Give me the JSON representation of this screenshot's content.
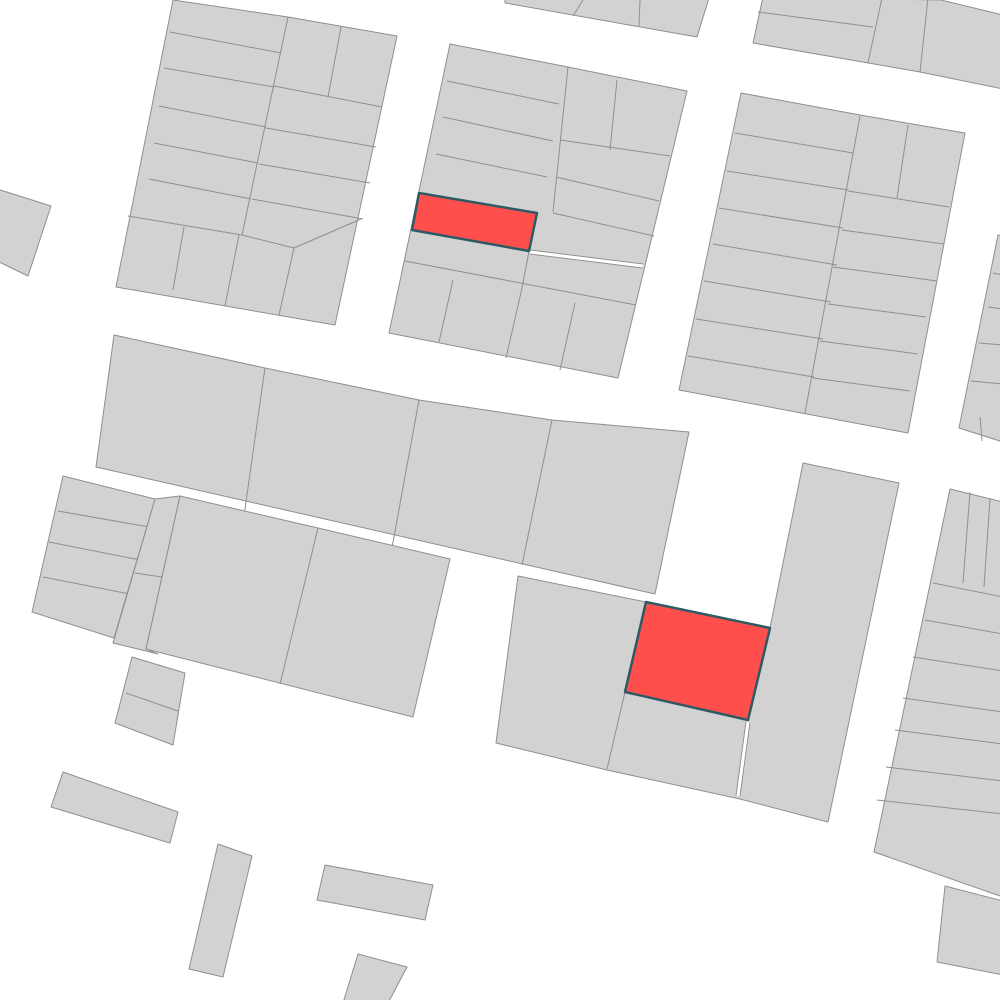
{
  "map": {
    "canvas": {
      "width": 1000,
      "height": 1000,
      "background_color": "#ffffff"
    },
    "style": {
      "parcel_fill": "#d2d2d2",
      "parcel_stroke": "#8f8f8f",
      "parcel_stroke_width": 1,
      "highlight_fill": "#ff4f4d",
      "highlight_stroke": "#2e5a63",
      "highlight_stroke_width": 2.5,
      "alley_fill": "#ffffff",
      "alley_width": 3,
      "alley_edge_offset": 2
    },
    "blocks": [
      {
        "name": "block-top-left",
        "outline": [
          173,
          0,
          288,
          17,
          397,
          36,
          335,
          325,
          116,
          287
        ],
        "lines": [
          [
            288,
            17,
            242,
            235
          ],
          [
            170,
            32,
            281,
            53
          ],
          [
            164,
            68,
            274,
            87
          ],
          [
            159,
            106,
            266,
            127
          ],
          [
            154,
            143,
            258,
            163
          ],
          [
            149,
            179,
            251,
            199
          ],
          [
            128,
            216,
            242,
            235
          ],
          [
            341,
            27,
            328,
            97
          ],
          [
            274,
            86,
            382,
            107
          ],
          [
            266,
            128,
            376,
            147
          ],
          [
            259,
            164,
            370,
            183
          ],
          [
            252,
            199,
            363,
            219
          ],
          [
            242,
            235,
            294,
            248
          ],
          [
            294,
            248,
            361,
            219
          ],
          [
            184,
            227,
            173,
            290
          ],
          [
            239,
            235,
            225,
            306
          ],
          [
            294,
            248,
            279,
            315
          ]
        ]
      },
      {
        "name": "block-left-edge-sliver",
        "outline": [
          -3,
          189,
          51,
          206,
          28,
          276,
          -3,
          261
        ],
        "lines": []
      },
      {
        "name": "block-top-center",
        "outline": [
          450,
          44,
          568,
          67,
          687,
          91,
          618,
          378,
          389,
          333
        ],
        "lines": [
          [
            568,
            67,
            553,
            212
          ],
          [
            529,
            251,
            522,
            288
          ],
          [
            447,
            81,
            559,
            104
          ],
          [
            443,
            117,
            553,
            141
          ],
          [
            436,
            154,
            547,
            177
          ],
          [
            405,
            261,
            636,
            305
          ],
          [
            617,
            80,
            610,
            150
          ],
          [
            560,
            140,
            670,
            156
          ],
          [
            556,
            177,
            659,
            201
          ],
          [
            553,
            213,
            654,
            236
          ],
          [
            453,
            280,
            439,
            342
          ],
          [
            522,
            288,
            506,
            358
          ],
          [
            575,
            303,
            560,
            370
          ]
        ]
      },
      {
        "name": "block-top-strip-west",
        "outline": [
          505,
          -2,
          709,
          -2,
          697,
          37,
          505,
          3
        ],
        "lines": [
          [
            583,
            0,
            573,
            16
          ],
          [
            640,
            0,
            639,
            26
          ]
        ]
      },
      {
        "name": "block-top-strip-east",
        "outline": [
          763,
          -3,
          941,
          0,
          1003,
          15,
          1003,
          89,
          920,
          72,
          753,
          43
        ],
        "lines": [
          [
            758,
            12,
            873,
            27
          ],
          [
            882,
            -2,
            868,
            63
          ],
          [
            928,
            -2,
            920,
            72
          ]
        ]
      },
      {
        "name": "block-top-right",
        "outline": [
          741,
          93,
          860,
          115,
          965,
          133,
          908,
          433,
          679,
          390
        ],
        "lines": [
          [
            860,
            116,
            805,
            413
          ],
          [
            735,
            133,
            853,
            153
          ],
          [
            727,
            171,
            848,
            190
          ],
          [
            719,
            208,
            843,
            228
          ],
          [
            713,
            244,
            837,
            265
          ],
          [
            704,
            281,
            831,
            302
          ],
          [
            696,
            319,
            823,
            339
          ],
          [
            688,
            356,
            814,
            377
          ],
          [
            908,
            125,
            897,
            198
          ],
          [
            848,
            191,
            949,
            207
          ],
          [
            842,
            230,
            944,
            244
          ],
          [
            833,
            267,
            937,
            281
          ],
          [
            828,
            304,
            926,
            317
          ],
          [
            820,
            341,
            918,
            354
          ],
          [
            813,
            378,
            910,
            391
          ]
        ]
      },
      {
        "name": "block-right-edge-upper",
        "outline": [
          998,
          235,
          1003,
          236,
          1003,
          442,
          959,
          428
        ],
        "lines": [
          [
            993,
            273,
            1003,
            275
          ],
          [
            988,
            307,
            1003,
            309
          ],
          [
            979,
            343,
            1003,
            345
          ],
          [
            971,
            381,
            1003,
            384
          ],
          [
            980,
            417,
            982,
            441
          ]
        ]
      },
      {
        "name": "block-middle-band",
        "outline": [
          114,
          335,
          265,
          368,
          419,
          400,
          552,
          420,
          689,
          432,
          655,
          594,
          96,
          467
        ],
        "lines": [
          [
            265,
            368,
            241,
            537
          ],
          [
            419,
            400,
            387,
            575
          ],
          [
            552,
            420,
            522,
            565
          ]
        ]
      },
      {
        "name": "block-left-strips",
        "outline": [
          63,
          476,
          155,
          499,
          114,
          638,
          32,
          612
        ],
        "lines": [
          [
            58,
            511,
            149,
            527
          ],
          [
            49,
            542,
            140,
            560
          ],
          [
            43,
            577,
            130,
            594
          ]
        ]
      },
      {
        "name": "block-narrow-column",
        "outline": [
          155,
          499,
          180,
          496,
          146,
          649,
          158,
          654,
          113,
          643
        ],
        "lines": [
          [
            135,
            573,
            162,
            577
          ]
        ]
      },
      {
        "name": "block-middle-left",
        "outline": [
          180,
          496,
          318,
          528,
          450,
          559,
          413,
          717,
          146,
          649
        ],
        "lines": [
          [
            318,
            528,
            280,
            684
          ]
        ]
      },
      {
        "name": "block-small-two-cell",
        "outline": [
          132,
          657,
          185,
          673,
          173,
          745,
          115,
          723
        ],
        "lines": [
          [
            126,
            693,
            178,
            711
          ]
        ]
      },
      {
        "name": "block-center-bottom",
        "outline": [
          518,
          576,
          646,
          602,
          770,
          628,
          803,
          463,
          899,
          483,
          828,
          822,
          740,
          799,
          607,
          770,
          496,
          743
        ],
        "lines": [
          [
            625,
            692,
            607,
            769
          ]
        ]
      },
      {
        "name": "block-right-strips",
        "outline": [
          950,
          489,
          1003,
          502,
          1003,
          897,
          874,
          852
        ],
        "lines": [
          [
            970,
            492,
            963,
            583
          ],
          [
            990,
            499,
            984,
            587
          ],
          [
            933,
            583,
            1003,
            597
          ],
          [
            925,
            620,
            1003,
            634
          ],
          [
            913,
            657,
            1003,
            671
          ],
          [
            903,
            698,
            1003,
            712
          ],
          [
            895,
            730,
            1003,
            744
          ],
          [
            886,
            767,
            1003,
            781
          ],
          [
            877,
            800,
            1003,
            814
          ]
        ]
      },
      {
        "name": "block-bottom-right-piece",
        "outline": [
          945,
          886,
          1003,
          901,
          1003,
          975,
          937,
          962
        ],
        "lines": []
      },
      {
        "name": "building-bottom-left-long",
        "outline": [
          63,
          772,
          178,
          812,
          170,
          843,
          51,
          807
        ],
        "lines": []
      },
      {
        "name": "building-bottom-column",
        "outline": [
          218,
          844,
          252,
          856,
          223,
          977,
          189,
          969
        ],
        "lines": []
      },
      {
        "name": "building-bottom-rect",
        "outline": [
          325,
          865,
          433,
          885,
          425,
          920,
          317,
          900
        ],
        "lines": []
      },
      {
        "name": "building-bottom-cut",
        "outline": [
          358,
          954,
          407,
          967,
          388,
          1003,
          343,
          1003
        ],
        "lines": []
      }
    ],
    "alleys": [
      {
        "name": "alley-top-center",
        "from": [
          530,
          252
        ],
        "to": [
          643,
          266
        ]
      },
      {
        "name": "alley-center-bottom",
        "from": [
          748,
          722
        ],
        "to": [
          738,
          796
        ]
      }
    ],
    "highlights": [
      {
        "name": "highlighted-parcel-north",
        "points": [
          419,
          193,
          537,
          213,
          529,
          251,
          412,
          230
        ]
      },
      {
        "name": "highlighted-parcel-center",
        "points": [
          646,
          602,
          770,
          628,
          748,
          720,
          625,
          692
        ]
      }
    ]
  }
}
